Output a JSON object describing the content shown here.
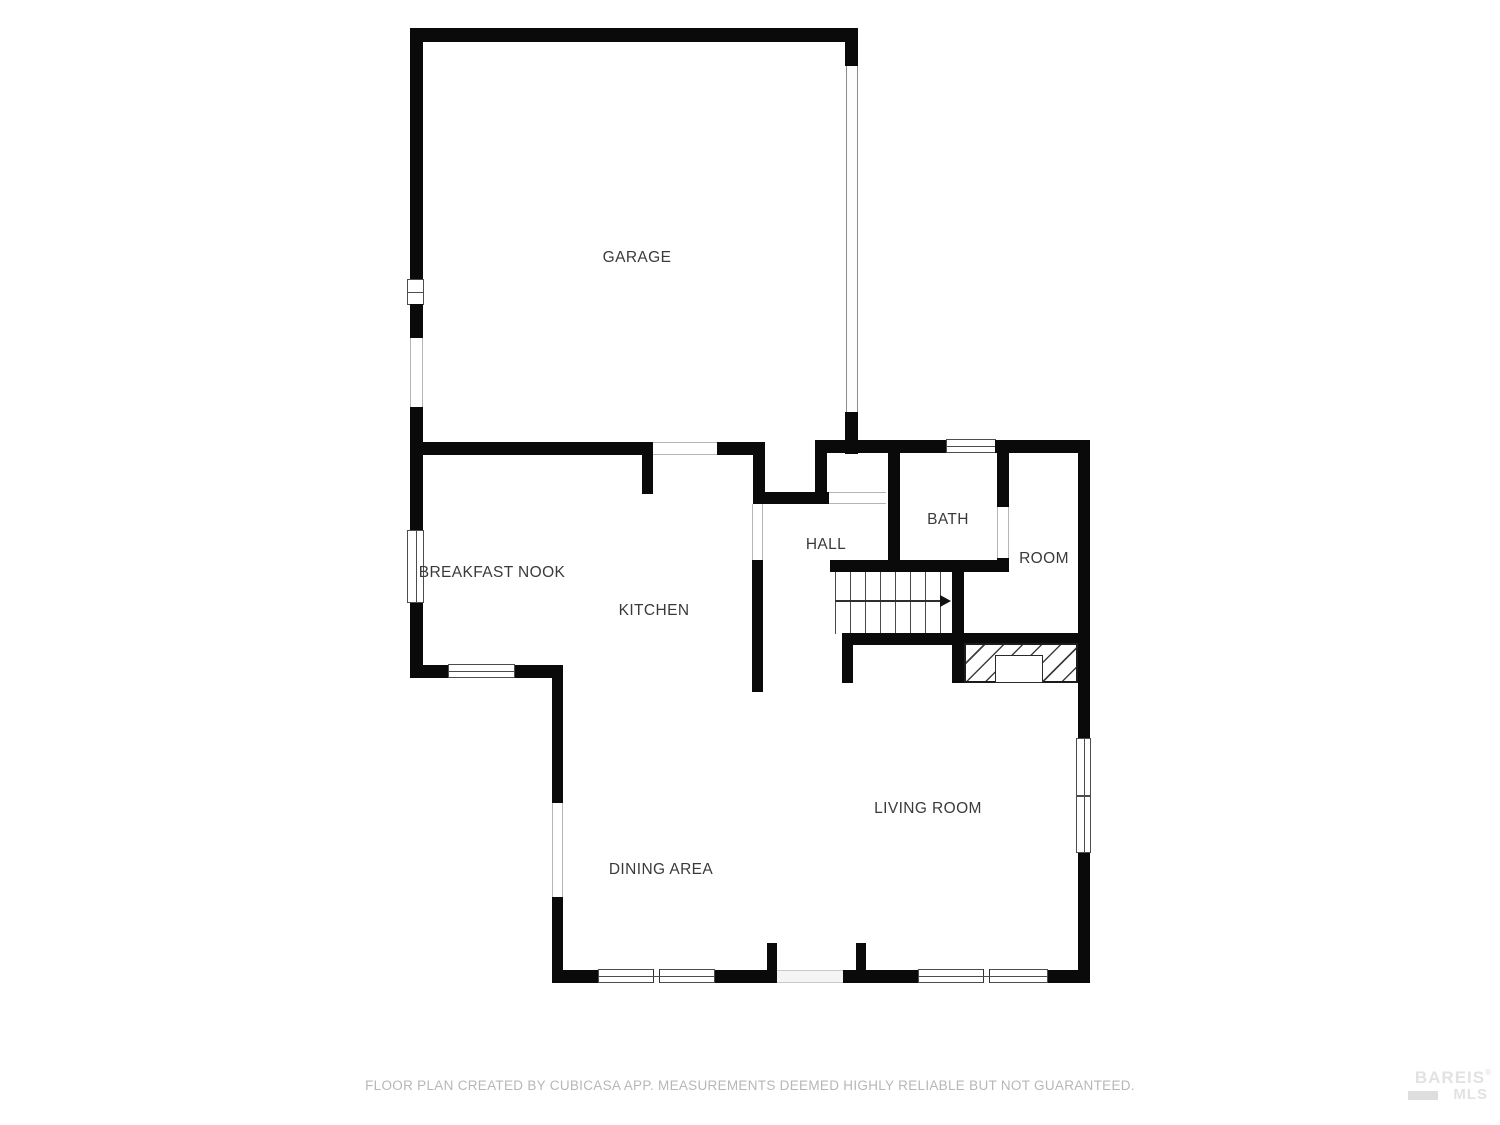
{
  "colors": {
    "wall": "#0a0a0a",
    "label": "#3a3a3a",
    "footer": "#b7b7b7",
    "watermark": "#e2e2e2",
    "frame": "#4d4d4d",
    "jamb": "#b5b5b5",
    "background": "#ffffff"
  },
  "plan": {
    "rooms": {
      "garage": {
        "label": "GARAGE"
      },
      "breakfast_nook": {
        "label": "BREAKFAST NOOK"
      },
      "kitchen": {
        "label": "KITCHEN"
      },
      "hall": {
        "label": "HALL"
      },
      "bath": {
        "label": "BATH"
      },
      "room": {
        "label": "ROOM"
      },
      "living_room": {
        "label": "LIVING ROOM"
      },
      "dining_area": {
        "label": "DINING AREA"
      }
    }
  },
  "footer": {
    "disclaimer": "FLOOR PLAN CREATED BY CUBICASA APP. MEASUREMENTS DEEMED HIGHLY RELIABLE BUT NOT GUARANTEED."
  },
  "watermark": {
    "name": "BAREIS MLS",
    "line1": "BAREIS",
    "registered": "®",
    "line2": "MLS"
  }
}
